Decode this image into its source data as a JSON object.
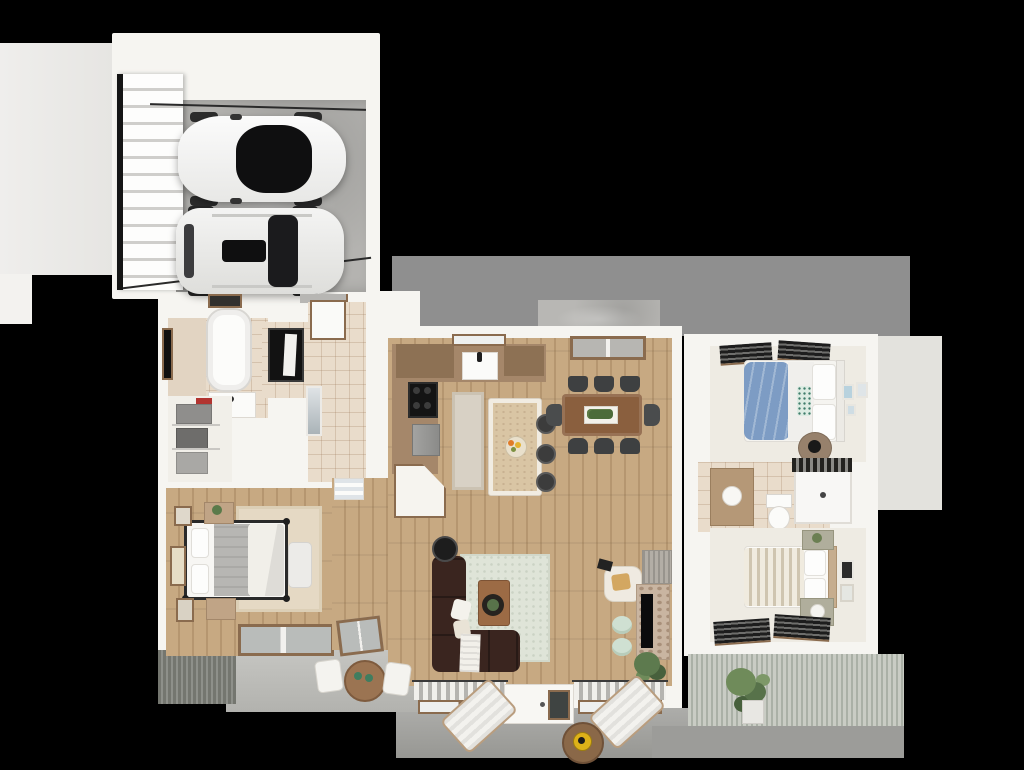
{
  "title": "3d-floor-plan-render",
  "view": "top-down-dollhouse",
  "canvas": {
    "width": 1024,
    "height": 770
  },
  "palette": {
    "background": "#000000",
    "wall": "#f6f5f1",
    "garage_floor": "#b4b3b0",
    "rear_band": "#8f8f8f",
    "concrete_pad": "#b8b7b4",
    "porch": "#a3a39f",
    "patio": "#c6c6c2",
    "right_pad": "#e3e2dd",
    "wood_floor": "#c7a982",
    "wood_cabinet": "#a5876a",
    "wood_trim": "#8a6b4e",
    "tile": "#e9dccb",
    "cream_floor": "#eeebe3",
    "rug_sage": "#dfe4d8",
    "rug_beige": "#e5d9c4",
    "runner": "#d8d1c5",
    "sofa_brown": "#3a251f",
    "bed_blue": "#7d9cc4",
    "mint": "#cfe0d2",
    "glass_dark": "#141414",
    "table_wood": "#8a5f3e",
    "accent_yellow": "#ddb119",
    "siding_light": "#c9ccc4",
    "car_white": "#fbfbfb"
  },
  "rooms": [
    {
      "name": "garage",
      "floor": "concrete",
      "items": [
        "car-sedan-white",
        "car-suv-white",
        "garage-door-panels",
        "door-track-rails"
      ]
    },
    {
      "name": "bathroom-1",
      "floor": "tile",
      "items": [
        "bathtub",
        "vanity-sink",
        "dark-window",
        "glass-shower"
      ]
    },
    {
      "name": "laundry-closet",
      "floor": "cream",
      "items": [
        "wire-shelves",
        "gray-baskets",
        "red-box"
      ]
    },
    {
      "name": "mudroom-hall",
      "floor": "tile",
      "items": [
        "white-cabinet",
        "tall-mirror",
        "garage-entry"
      ]
    },
    {
      "name": "pantry",
      "floor": "wood",
      "items": [
        "wood-shelving"
      ]
    },
    {
      "name": "master-bedroom",
      "floor": "wood",
      "items": [
        "metal-frame-bed",
        "gray-duvet",
        "two-nightstands",
        "beige-rug",
        "bench",
        "wall-art-frames",
        "rear-window"
      ]
    },
    {
      "name": "hallway",
      "floor": "wood",
      "items": [
        "linen-shelves",
        "patio-french-door"
      ]
    },
    {
      "name": "kitchen",
      "floor": "wood",
      "items": [
        "l-shaped-wood-counter",
        "farmhouse-sink",
        "window-over-sink",
        "black-range",
        "dishwasher",
        "corner-cabinet",
        "island-with-fruit-bowl",
        "three-stools",
        "runner-rug"
      ]
    },
    {
      "name": "dining-area",
      "floor": "wood",
      "items": [
        "wood-table",
        "eight-dark-chairs",
        "planter-centerpiece",
        "rear-window"
      ]
    },
    {
      "name": "living-room",
      "floor": "wood",
      "items": [
        "brown-sectional-sofa",
        "white-pillows",
        "throw-blanket",
        "sage-rug",
        "coffee-table-with-plant",
        "record-player",
        "accent-chair",
        "ribbed-gray-cabinet",
        "stone-fireplace-tv",
        "two-mint-poufs",
        "indoor-plant",
        "striped-curtain-windows",
        "front-door"
      ]
    },
    {
      "name": "bedroom-2",
      "floor": "cream",
      "items": [
        "bed-blue-duvet",
        "white-pillows",
        "patterned-pillow",
        "round-nightstand",
        "wall-art-blue",
        "dark-slat-blinds"
      ]
    },
    {
      "name": "closet-2",
      "floor": "cream",
      "items": [
        "dresser",
        "louver-doors"
      ]
    },
    {
      "name": "bathroom-2",
      "floor": "tile",
      "items": [
        "wood-vanity",
        "toilet",
        "shower-striped-curtain"
      ]
    },
    {
      "name": "bedroom-3",
      "floor": "cream",
      "items": [
        "bed-striped-duvet",
        "sage-nightstands",
        "lamp",
        "wall-art",
        "dark-slat-blinds"
      ]
    },
    {
      "name": "front-porch",
      "floor": "concrete",
      "items": [
        "two-lounge-chairs",
        "round-side-table",
        "yellow-bowl",
        "potted-plant"
      ]
    },
    {
      "name": "side-patio",
      "floor": "concrete",
      "items": [
        "round-wood-table",
        "two-white-chairs",
        "green-cups"
      ]
    },
    {
      "name": "rear-patio",
      "floor": "concrete",
      "items": [
        "concrete-pad"
      ]
    }
  ],
  "vehicles": [
    {
      "name": "sedan",
      "color": "white",
      "position": "upper-bay"
    },
    {
      "name": "suv",
      "color": "white",
      "position": "lower-bay"
    }
  ]
}
